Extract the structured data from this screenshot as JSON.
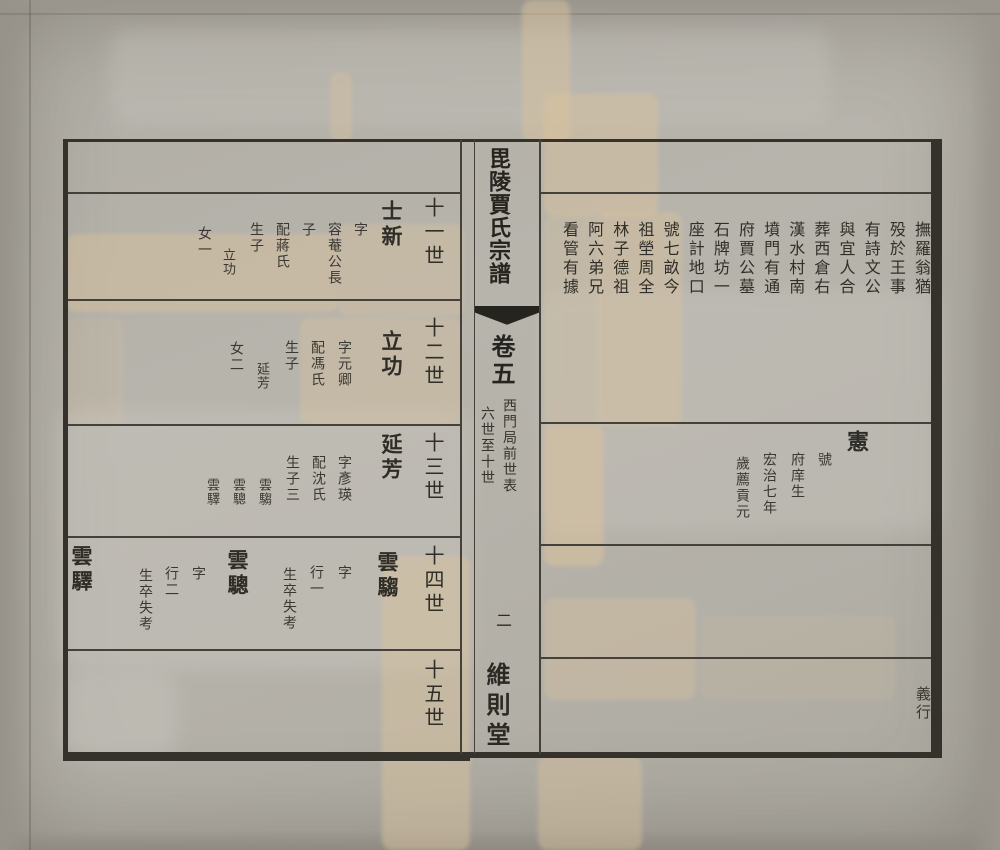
{
  "spine": {
    "book_title": "毘陵賈氏宗譜",
    "volume": "卷五",
    "section_title": "西門局前世表",
    "generation_range": "六世至十世",
    "page_number": "二",
    "hall_name": "維則堂"
  },
  "right_page": {
    "burial_note_columns": [
      "撫羅翁猶",
      "殁於王事",
      "有詩文公",
      "與宜人合",
      "葬西倉右",
      "漢水村南",
      "墳門有通",
      "府賈公墓",
      "石牌坊一",
      "座計地口",
      "號七畝今",
      "祖塋周全",
      "林子德祖",
      "阿六弟兄",
      "看管有據"
    ],
    "entry": {
      "name": "憲",
      "note_columns": [
        "號",
        "府庠生",
        "宏治七年",
        "歲薦貢元"
      ]
    },
    "category_label": "義行"
  },
  "left_page": {
    "bands": [
      {
        "header": "十一世",
        "entries": [
          {
            "name": "士新",
            "notes": [
              "字",
              "容菴公長",
              "子",
              "配蔣氏",
              "生子",
              "立功",
              "女一"
            ]
          }
        ]
      },
      {
        "header": "十二世",
        "entries": [
          {
            "name": "立功",
            "notes": [
              "字元卿",
              "配馮氏",
              "生子",
              "延芳",
              "女二"
            ]
          }
        ]
      },
      {
        "header": "十三世",
        "entries": [
          {
            "name": "延芳",
            "notes": [
              "字彥瑛",
              "配沈氏",
              "生子三",
              "雲騶",
              "雲驄",
              "雲驛"
            ]
          }
        ]
      },
      {
        "header": "十四世",
        "entries": [
          {
            "name": "雲騶",
            "notes": [
              "字",
              "行一",
              "生卒失考"
            ]
          },
          {
            "name": "雲驄",
            "notes": [
              "字",
              "行二",
              "生卒失考"
            ]
          },
          {
            "name": "雲驛",
            "notes": []
          }
        ]
      },
      {
        "header": "十五世",
        "entries": []
      }
    ]
  }
}
